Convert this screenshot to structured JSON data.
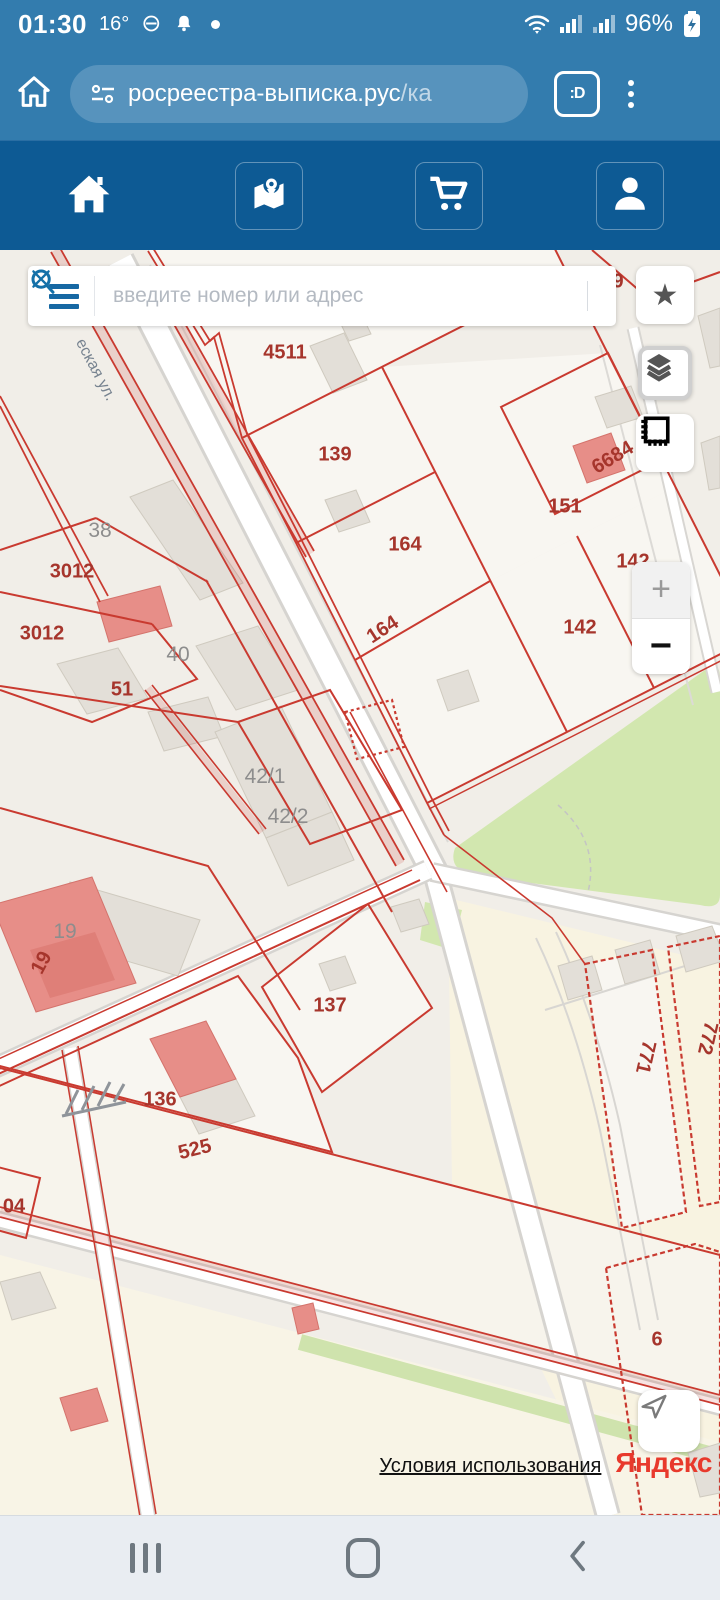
{
  "status_bar": {
    "time": "01:30",
    "temperature": "16°",
    "battery_percent": "96%"
  },
  "browser": {
    "url": "росреестра-выписка.рус",
    "url_path": "/ка",
    "tab_badge": ":D"
  },
  "site_nav": {
    "icons": [
      "home",
      "map-marker",
      "cart",
      "profile"
    ]
  },
  "search": {
    "placeholder": "введите номер или адрес"
  },
  "map": {
    "street_label": "еская ул.",
    "labels": [
      {
        "text": "9"
      },
      {
        "text": "4511"
      },
      {
        "text": "139"
      },
      {
        "text": "164"
      },
      {
        "text": "164"
      },
      {
        "text": "151"
      },
      {
        "text": "6684"
      },
      {
        "text": "142"
      },
      {
        "text": "142"
      },
      {
        "text": "3012"
      },
      {
        "text": "3012"
      },
      {
        "text": "51"
      },
      {
        "text": "38"
      },
      {
        "text": "40"
      },
      {
        "text": "42/1"
      },
      {
        "text": "42/2"
      },
      {
        "text": "19"
      },
      {
        "text": "19"
      },
      {
        "text": "137"
      },
      {
        "text": "136"
      },
      {
        "text": "525"
      },
      {
        "text": "04"
      },
      {
        "text": "771"
      },
      {
        "text": "772"
      },
      {
        "text": "6"
      }
    ],
    "controls": {
      "zoom_in": "+",
      "zoom_out": "−",
      "star": "★"
    },
    "attribution": {
      "terms": "Условия использования",
      "logo": "Яндекс"
    }
  },
  "colors": {
    "top_bar": "#337cae",
    "site_bar": "#0d5a94",
    "parcel_line": "#c93a30",
    "parcel_label": "#a6352c",
    "building": "#e3dfd8",
    "building_red": "#e78e88",
    "green": "#d2e7af",
    "yandex_red": "#e8392c"
  }
}
